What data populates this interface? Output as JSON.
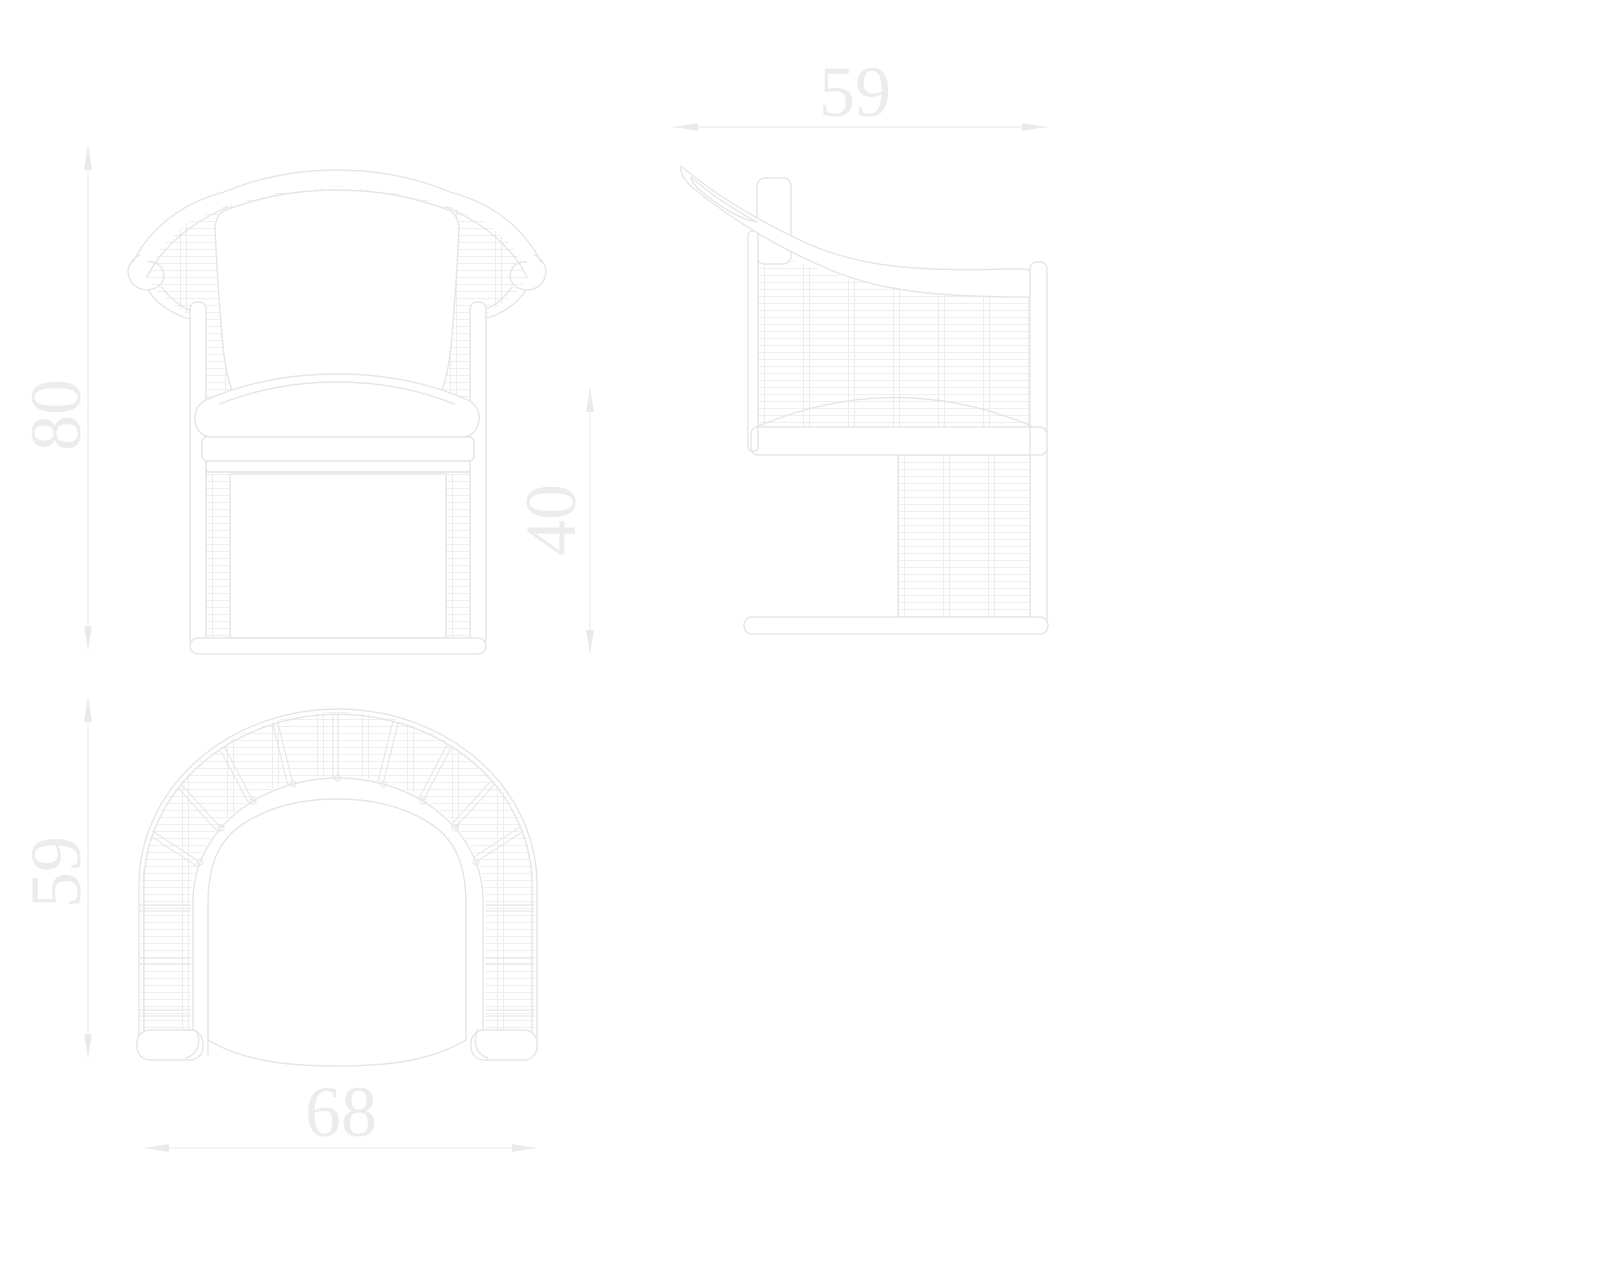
{
  "dimensions": {
    "overall_height": {
      "value": "80",
      "orientation": "vertical",
      "located": "left of front view"
    },
    "side_depth": {
      "value": "59",
      "orientation": "horizontal",
      "located": "above side view"
    },
    "seat_height": {
      "value": "40",
      "orientation": "vertical",
      "located": "right of front view"
    },
    "plan_depth": {
      "value": "59",
      "orientation": "vertical",
      "located": "left of plan view"
    },
    "overall_width": {
      "value": "68",
      "orientation": "horizontal",
      "located": "below plan view"
    }
  },
  "colors": {
    "background": "#ffffff",
    "outline": "#e5e5e5",
    "hatch_row": "#efefef",
    "hatch_column": "#ededed",
    "dimension_line": "#ececec",
    "label_text": "#ececec"
  }
}
